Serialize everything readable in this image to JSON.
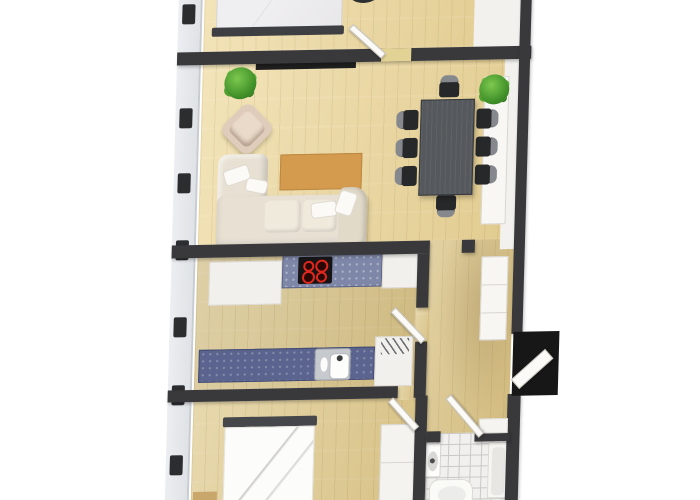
{
  "meta": {
    "description": "3D rendered top-down apartment floor plan on white background",
    "view": "top-down",
    "background_color": "#ffffff",
    "no_visible_text": true
  },
  "rooms": [
    {
      "id": "bedroom-top",
      "label": "Bedroom (top, partially cut off)",
      "furniture": [
        "double bed with dark footboard",
        "dark stool"
      ]
    },
    {
      "id": "living-dining",
      "label": "Living / dining room",
      "furniture": [
        "cream corner sofa with pillows",
        "cream armchair",
        "orange rug",
        "dark wall bench",
        "potted plant",
        "dining table (dark grey)",
        "8 dining chairs",
        "white sideboard with potted plant"
      ]
    },
    {
      "id": "kitchen",
      "label": "Kitchen",
      "furniture": [
        "blue upper countertop",
        "black cooktop with 4 red burners",
        "white cabinets",
        "blue lower countertop",
        "stainless sink",
        "dish rack"
      ]
    },
    {
      "id": "hallway",
      "label": "Hallway / entry",
      "furniture": [
        "white closet",
        "black entry door, open"
      ]
    },
    {
      "id": "bedroom-bottom",
      "label": "Bedroom (bottom, partially cut off)",
      "furniture": [
        "white double bed with dark headboard",
        "white wardrobe",
        "small tan rug"
      ]
    },
    {
      "id": "bathroom",
      "label": "Bathroom",
      "furniture": [
        "washbasin",
        "toilet",
        "shower / bathtub",
        "white tiled floor"
      ]
    }
  ],
  "counts": {
    "dining_chairs": 8,
    "cooktop_burners": 4,
    "left_wall_windows": 7,
    "interior_door_leaves": 4,
    "entry_doors": 1,
    "potted_plants": 2
  },
  "colors": {
    "floor_wood": "#ddc88e",
    "wall_dark": "#39383a",
    "wall_face_light": "#f2f1ee",
    "exterior_wall_gray": "#e6e8ec",
    "window_frame_dark": "#2b2d2f",
    "rug_orange": "#d49a4e",
    "sofa_cream": "#e7e0d3",
    "armchair_beige": "#dfccba",
    "dining_table_gray": "#55595d",
    "chair_seat_black": "#26282a",
    "chair_back_gray": "#85898d",
    "plant_green": "#3f8f28",
    "counter_blue_upper": "#7e87a8",
    "counter_blue_lower": "#5a648e",
    "cooktop_black": "#161414",
    "burner_red": "#e0271c",
    "sink_steel": "#c6c9cd",
    "bed_white": "#fcfcfb",
    "headboard_dark": "#45474a",
    "tile_floor": "#f1f0ee",
    "tile_grout": "#c8c7c4",
    "entry_door_black": "#171717",
    "door_leaf_white": "#fbfaf7"
  }
}
